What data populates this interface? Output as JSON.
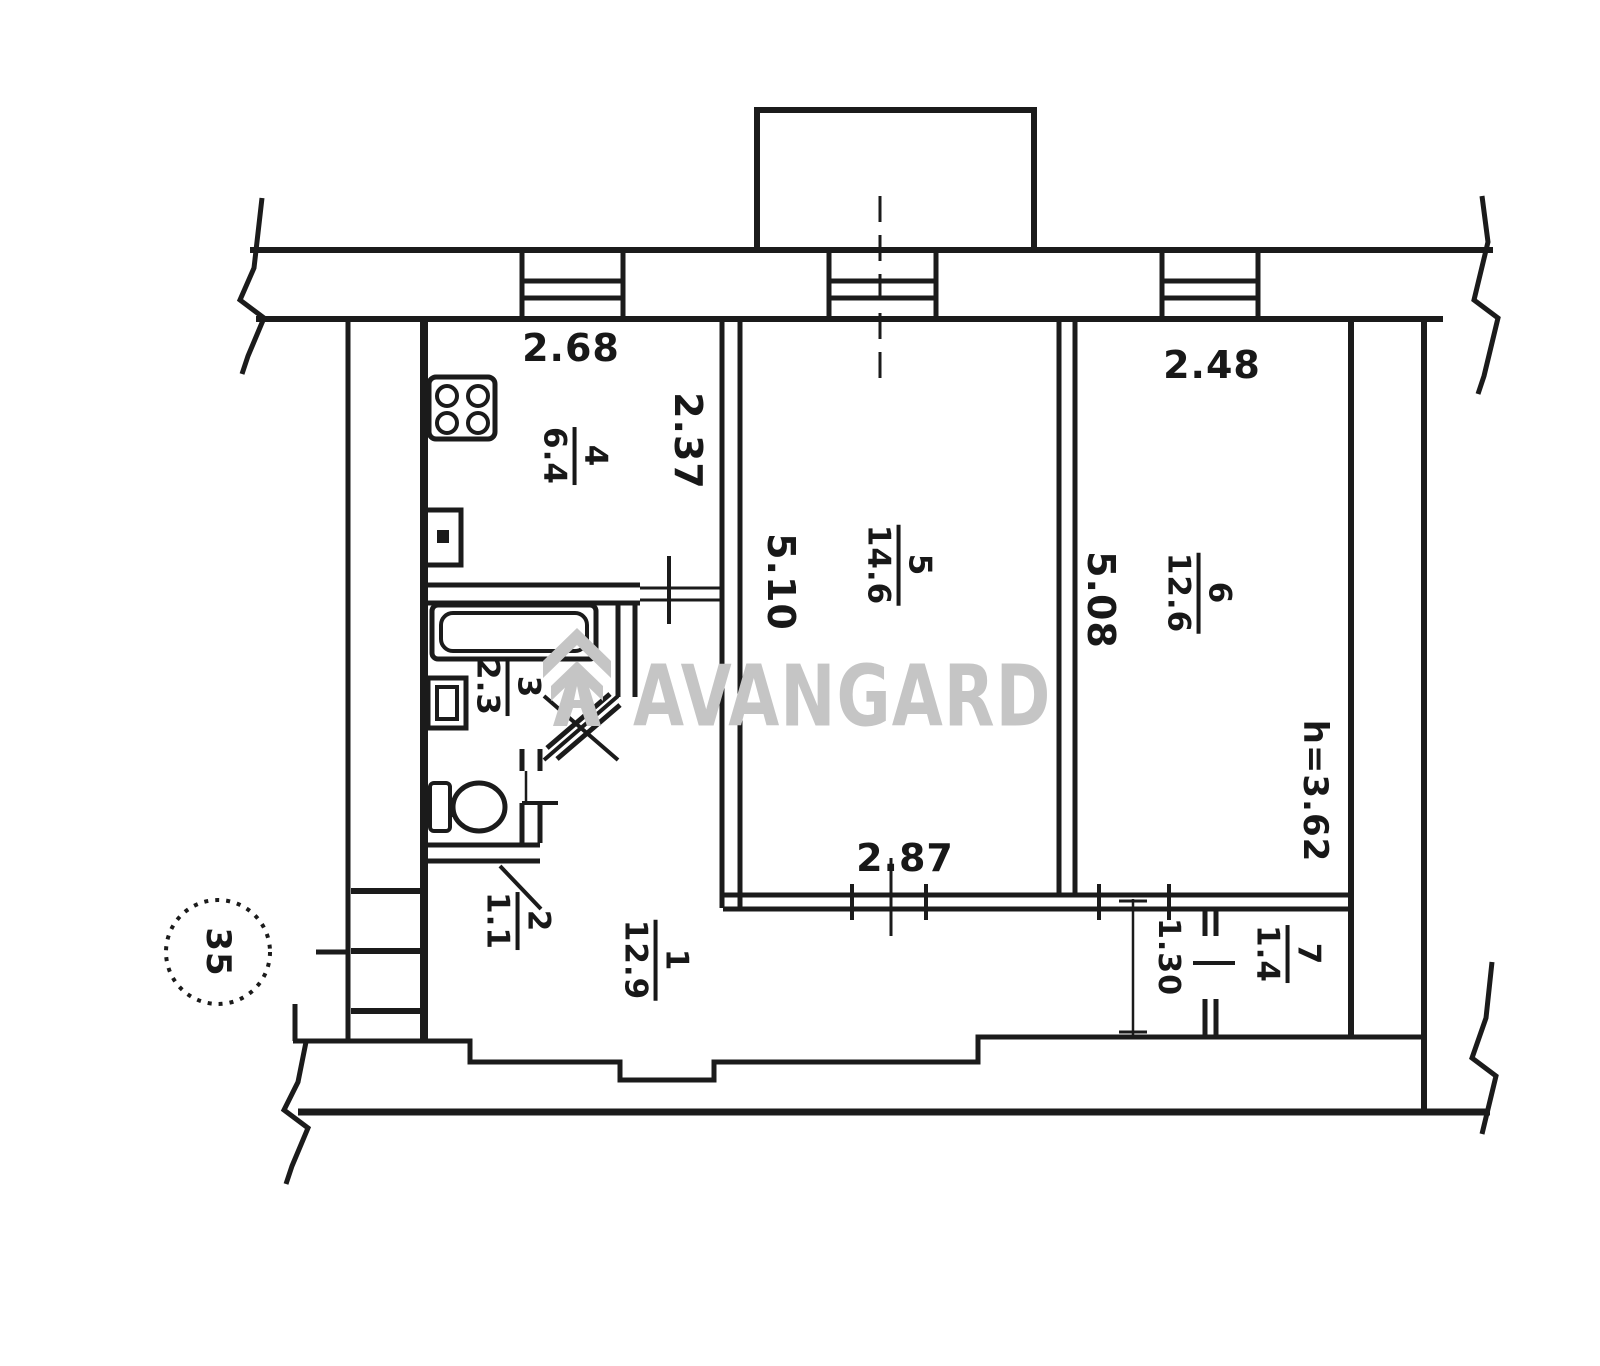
{
  "plan": {
    "watermark": "AVANGARD",
    "unit_number": "35",
    "ceiling_height": "h=3.62",
    "rooms": [
      {
        "number": "1",
        "area": "12.9"
      },
      {
        "number": "2",
        "area": "1.1"
      },
      {
        "number": "3",
        "area": "2.3"
      },
      {
        "number": "4",
        "area": "6.4"
      },
      {
        "number": "5",
        "area": "14.6"
      },
      {
        "number": "6",
        "area": "12.6"
      },
      {
        "number": "7",
        "area": "1.4"
      }
    ],
    "dimensions": {
      "kitchen_width": "2.68",
      "kitchen_depth": "2.37",
      "room5_width": "2.87",
      "room5_depth": "5.10",
      "room6_width": "2.48",
      "room6_depth": "5.08",
      "corridor_width": "1.30"
    }
  }
}
